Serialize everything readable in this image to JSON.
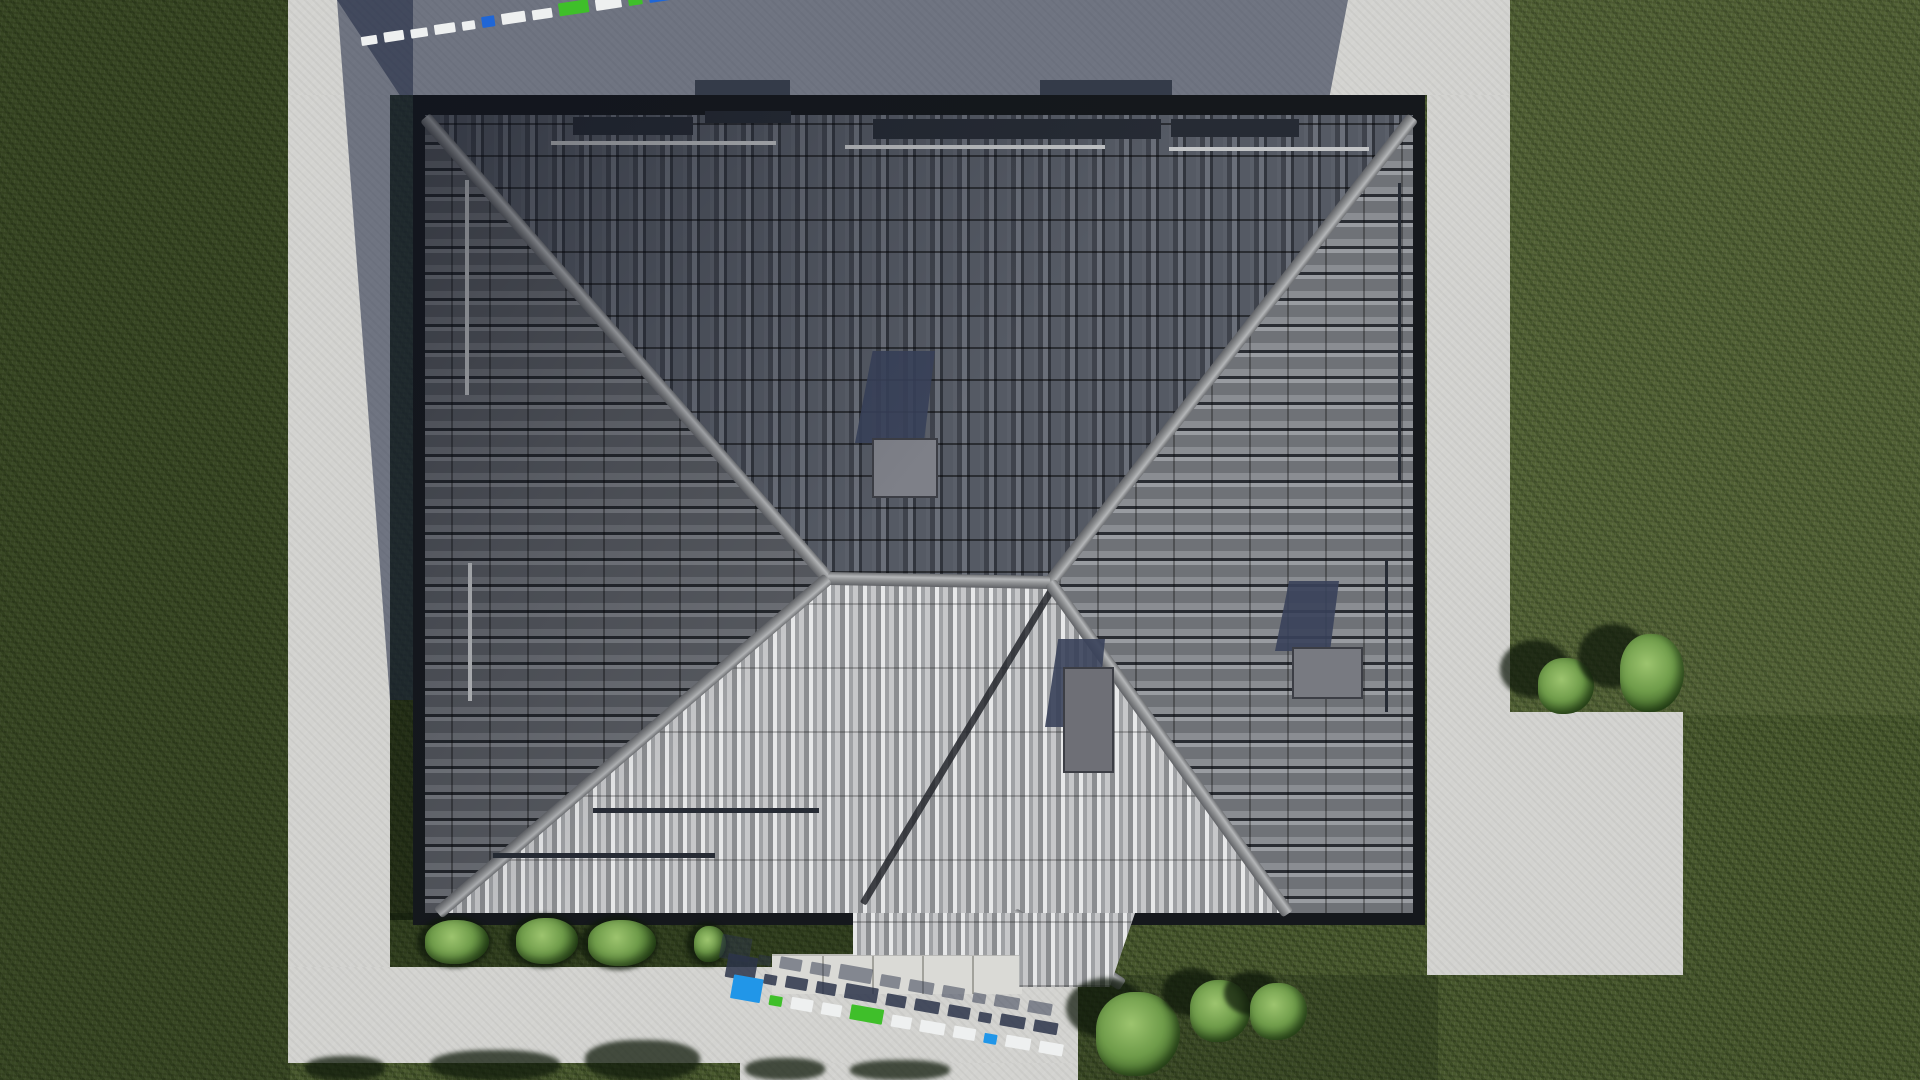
{
  "logo": {
    "text": "FixPlans.ru",
    "x": 1160,
    "y": 26,
    "letters": [
      {
        "ch": "F",
        "color": "#1e63da"
      },
      {
        "ch": "i",
        "color": "#2aa630"
      },
      {
        "ch": "x",
        "color": "#ececec"
      },
      {
        "ch": "P",
        "color": "#2aa630"
      },
      {
        "ch": "l",
        "color": "#ececec"
      },
      {
        "ch": "a",
        "color": "#ececec"
      },
      {
        "ch": "n",
        "color": "#ececec"
      },
      {
        "ch": "s",
        "color": "#ececec"
      },
      {
        "ch": ".",
        "color": "#1e63da"
      },
      {
        "ch": "r",
        "color": "#ececec"
      },
      {
        "ch": "u",
        "color": "#ececec"
      }
    ]
  },
  "palette": {
    "grass": "#49592e",
    "pavement": "#d3d3d0",
    "shadow": "rgba(30,38,64,0.55)",
    "roof_border": "#15181c",
    "ridge": "#9fa1a3",
    "valley": "#24272d",
    "chimney_shadow": "#39415a",
    "watermark_blue": "#1f66d6",
    "watermark_blue_bright": "#2196e8",
    "watermark_green": "#3fbf2a",
    "watermark_white": "#eef0f0",
    "rail_dark": "#262b34",
    "rail_light": "#c3c5c7"
  },
  "ground": {
    "overlays": [
      [
        0,
        0,
        290,
        1080,
        "rgba(18,28,10,0.28)"
      ],
      [
        385,
        913,
        480,
        57,
        "rgba(14,24,8,0.38)"
      ],
      [
        1078,
        975,
        360,
        105,
        "rgba(12,22,8,0.20)"
      ],
      [
        390,
        95,
        25,
        825,
        "rgba(8,14,6,0.55)"
      ],
      [
        1510,
        0,
        410,
        715,
        "rgba(255,255,200,0.05)"
      ]
    ]
  },
  "pavement": {
    "areas": [
      [
        288,
        0,
        1222,
        95
      ],
      [
        288,
        95,
        102,
        872
      ],
      [
        1427,
        95,
        83,
        617
      ],
      [
        1427,
        712,
        256,
        263
      ],
      [
        288,
        967,
        790,
        96
      ],
      [
        740,
        1063,
        338,
        17
      ]
    ],
    "steps": {
      "x": 772,
      "y": 954,
      "w": 250,
      "h": 38,
      "joints": 4
    }
  },
  "shadows": [
    {
      "x": 337,
      "y": 0,
      "w": 1011,
      "h": 95,
      "clip": "polygon(0% 0%,100% 0%,98.2% 100%,6.2% 100%)"
    },
    {
      "x": 337,
      "y": 0,
      "w": 76,
      "h": 700,
      "clip": "polygon(0% 0%,100% 0%,100% 100%,69.7% 100%)"
    }
  ],
  "tree_shadows": [
    [
      305,
      1056,
      80,
      24
    ],
    [
      430,
      1050,
      130,
      30
    ],
    [
      585,
      1040,
      115,
      40
    ],
    [
      745,
      1058,
      80,
      22
    ],
    [
      850,
      1060,
      100,
      20
    ]
  ],
  "eave_strips": [
    [
      695,
      80,
      95,
      16
    ],
    [
      1040,
      80,
      132,
      16
    ]
  ],
  "roof": {
    "x": 413,
    "y": 95,
    "w": 1012,
    "h": 830,
    "slopes": [
      {
        "name": "north-slope",
        "cls": "slope-n",
        "clip": "polygon(12px 20px,1000px 20px,637px 487px,415px 483px)"
      },
      {
        "name": "west-slope",
        "cls": "slope-w",
        "clip": "polygon(12px 20px,415px 483px,25px 818px,12px 818px)"
      },
      {
        "name": "east-slope",
        "cls": "slope-e",
        "clip": "polygon(1000px 20px,1000px 818px,875px 818px,637px 487px)"
      },
      {
        "name": "south-slope",
        "cls": "slope-s",
        "clip": "polygon(415px 483px,637px 487px,875px 818px,25px 818px)"
      }
    ],
    "ridges": [
      [
        12,
        22,
        415,
        483
      ],
      [
        1000,
        22,
        637,
        487
      ],
      [
        415,
        483,
        637,
        487
      ],
      [
        415,
        483,
        25,
        818
      ],
      [
        637,
        487,
        875,
        818
      ],
      [
        600,
        818,
        710,
        890
      ]
    ],
    "valleys": [
      [
        640,
        492,
        450,
        808
      ]
    ],
    "rails_dark": [
      [
        160,
        22,
        120,
        18
      ],
      [
        292,
        16,
        86,
        12
      ],
      [
        460,
        24,
        288,
        20
      ],
      [
        758,
        24,
        128,
        18
      ],
      [
        80,
        758,
        222,
        5
      ],
      [
        180,
        713,
        226,
        5
      ],
      [
        472,
        850,
        222,
        5
      ],
      [
        972,
        465,
        3,
        152
      ],
      [
        985,
        88,
        3,
        298
      ]
    ],
    "rails_light": [
      [
        138,
        46,
        225,
        4
      ],
      [
        432,
        50,
        260,
        4
      ],
      [
        756,
        52,
        200,
        4
      ],
      [
        52,
        85,
        4,
        215
      ],
      [
        55,
        468,
        4,
        138
      ]
    ],
    "chimneys": [
      {
        "shadow": [
          442,
          256,
          80,
          92
        ],
        "block": [
          459,
          343,
          62,
          56
        ],
        "block_color": "#7e8088"
      },
      {
        "shadow": [
          632,
          544,
          60,
          88
        ],
        "block": [
          650,
          572,
          47,
          102
        ],
        "block_color": "#6e6f76"
      },
      {
        "shadow": [
          862,
          486,
          64,
          70
        ],
        "block": [
          879,
          552,
          67,
          48
        ],
        "block_color": "#787a81"
      }
    ],
    "porch": {
      "x": 853,
      "y": 913,
      "w": 282,
      "h": 74,
      "clip": "polygon(0% 0%,100% 0%,91% 100%,59% 100%,59% 57%,0% 57%)"
    }
  },
  "bushes": {
    "hedge_row": [
      [
        425,
        920,
        64,
        44
      ],
      [
        516,
        918,
        62,
        46
      ],
      [
        588,
        920,
        68,
        46
      ],
      [
        694,
        926,
        32,
        36
      ]
    ],
    "right_pair": [
      {
        "b": [
          1538,
          658,
          56,
          56
        ],
        "s": [
          1500,
          640,
          70,
          58
        ]
      },
      {
        "b": [
          1620,
          634,
          64,
          78
        ],
        "s": [
          1578,
          624,
          70,
          64
        ]
      }
    ],
    "bottom_right": [
      {
        "b": [
          1096,
          992,
          84,
          84
        ],
        "s": [
          1066,
          978,
          80,
          60
        ]
      },
      {
        "b": [
          1190,
          980,
          60,
          62
        ],
        "s": [
          1162,
          968,
          60,
          48
        ]
      },
      {
        "b": [
          1250,
          983,
          57,
          57
        ],
        "s": [
          1224,
          971,
          56,
          44
        ]
      }
    ]
  },
  "watermarks": {
    "top_left": {
      "x": 362,
      "y": 46,
      "angle": -8.5,
      "gap": 7,
      "shadow": "none",
      "blocks": [
        {
          "c": "white",
          "w": 16,
          "h": 9
        },
        {
          "c": "white",
          "w": 20,
          "h": 10
        },
        {
          "c": "white",
          "w": 17,
          "h": 9
        },
        {
          "c": "white",
          "w": 21,
          "h": 10
        },
        {
          "c": "white",
          "w": 13,
          "h": 9
        },
        {
          "c": "blue",
          "w": 13,
          "h": 11
        },
        {
          "c": "white",
          "w": 24,
          "h": 11
        },
        {
          "c": "white",
          "w": 20,
          "h": 10
        },
        {
          "c": "green",
          "w": 30,
          "h": 13
        },
        {
          "c": "white",
          "w": 26,
          "h": 11
        },
        {
          "c": "green",
          "w": 14,
          "h": 12
        },
        {
          "c": "blue_big",
          "w": 36,
          "h": 26
        }
      ]
    },
    "bottom_center": {
      "x": 730,
      "y": 998,
      "angle": 10,
      "gap": 9,
      "shadow": "-9px -20px 0 rgba(43,52,74,0.85), -18px -38px 0 rgba(43,52,74,0.5)",
      "blocks": [
        {
          "c": "blue_bright",
          "w": 30,
          "h": 24
        },
        {
          "c": "green",
          "w": 13,
          "h": 10
        },
        {
          "c": "white",
          "w": 22,
          "h": 12
        },
        {
          "c": "white",
          "w": 20,
          "h": 12
        },
        {
          "c": "green",
          "w": 33,
          "h": 15
        },
        {
          "c": "white",
          "w": 20,
          "h": 12
        },
        {
          "c": "white",
          "w": 25,
          "h": 12
        },
        {
          "c": "white",
          "w": 22,
          "h": 12
        },
        {
          "c": "blue_bright",
          "w": 13,
          "h": 10
        },
        {
          "c": "white",
          "w": 25,
          "h": 12
        },
        {
          "c": "white",
          "w": 24,
          "h": 12
        }
      ]
    }
  }
}
